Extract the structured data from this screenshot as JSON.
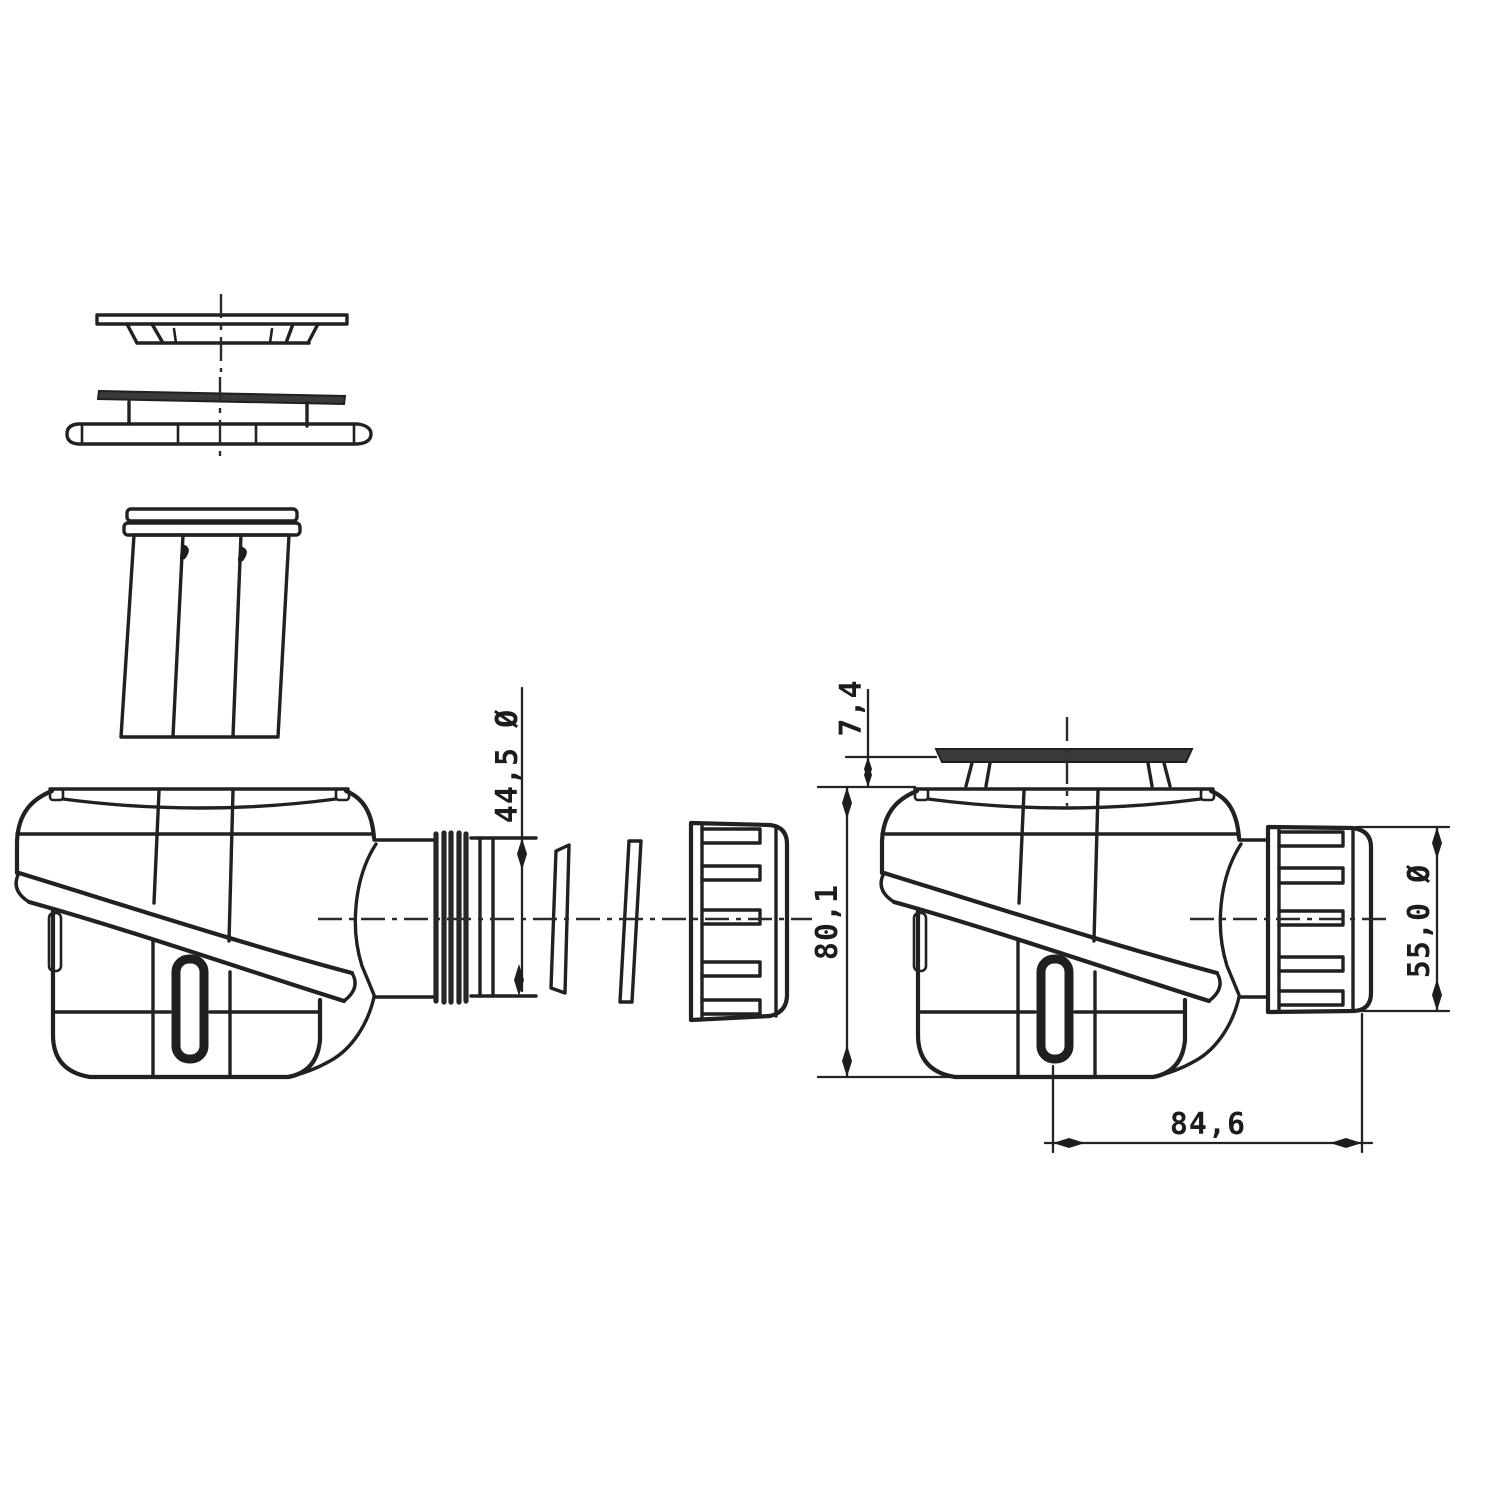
{
  "dims": {
    "pipe_od": "44,5 Ø",
    "cover_height": "7,4",
    "body_height": "80,1",
    "nut_od": "55,0 Ø",
    "outlet_length": "84,6"
  },
  "colors": {
    "ink": "#212121",
    "background": "#ffffff",
    "dark_fill": "#3a3a3a"
  }
}
